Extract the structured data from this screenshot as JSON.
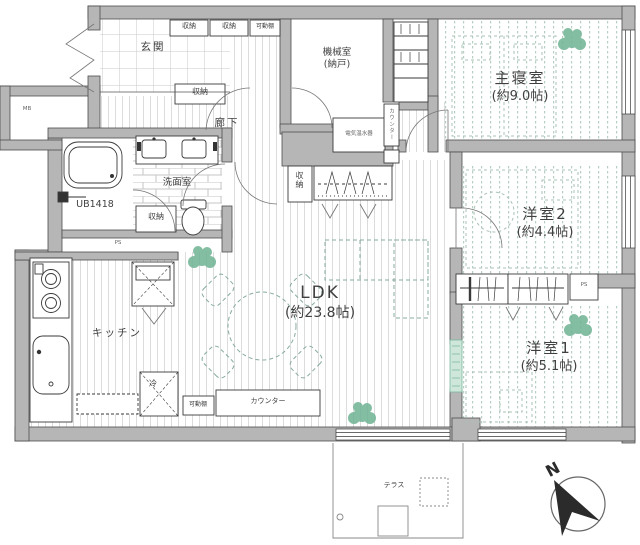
{
  "plan_type": "floor-plan",
  "rooms": {
    "entrance": {
      "name": "玄関"
    },
    "hallway": {
      "name": "廊下"
    },
    "machine_room": {
      "name": "機械室",
      "sub": "(納戸)"
    },
    "master_bedroom": {
      "name": "主寝室",
      "size": "(約9.0帖)"
    },
    "bedroom2": {
      "name": "洋室2",
      "size": "(約4.4帖)"
    },
    "bedroom1": {
      "name": "洋室1",
      "size": "(約5.1帖)"
    },
    "ldk": {
      "name": "LDK",
      "size": "(約23.8帖)"
    },
    "kitchen": {
      "name": "キッチン"
    },
    "washroom": {
      "name": "洗面室"
    },
    "bathroom": {
      "name": "UB1418"
    },
    "terrace": {
      "name": "テラス"
    }
  },
  "labels": {
    "storage": "収納",
    "movable_shelf": "可動棚",
    "counter": "カウンター",
    "fridge": "冷",
    "water_heater": "電気温水器",
    "meter_box": "MB",
    "pipe_space": "PS",
    "north": "N"
  },
  "colors": {
    "wall": "#b6b6b6",
    "wall_outline": "#4d4d4d",
    "line": "#3a3a3a",
    "floor_hatch": "#dcdcdc",
    "bedroom_dots": "#b7cfc3",
    "furniture_dash": "#86ab9c",
    "plant_green": "#72b496",
    "accordion_door": "#cfe6da",
    "compass_arrow": "#2b2b2b"
  }
}
